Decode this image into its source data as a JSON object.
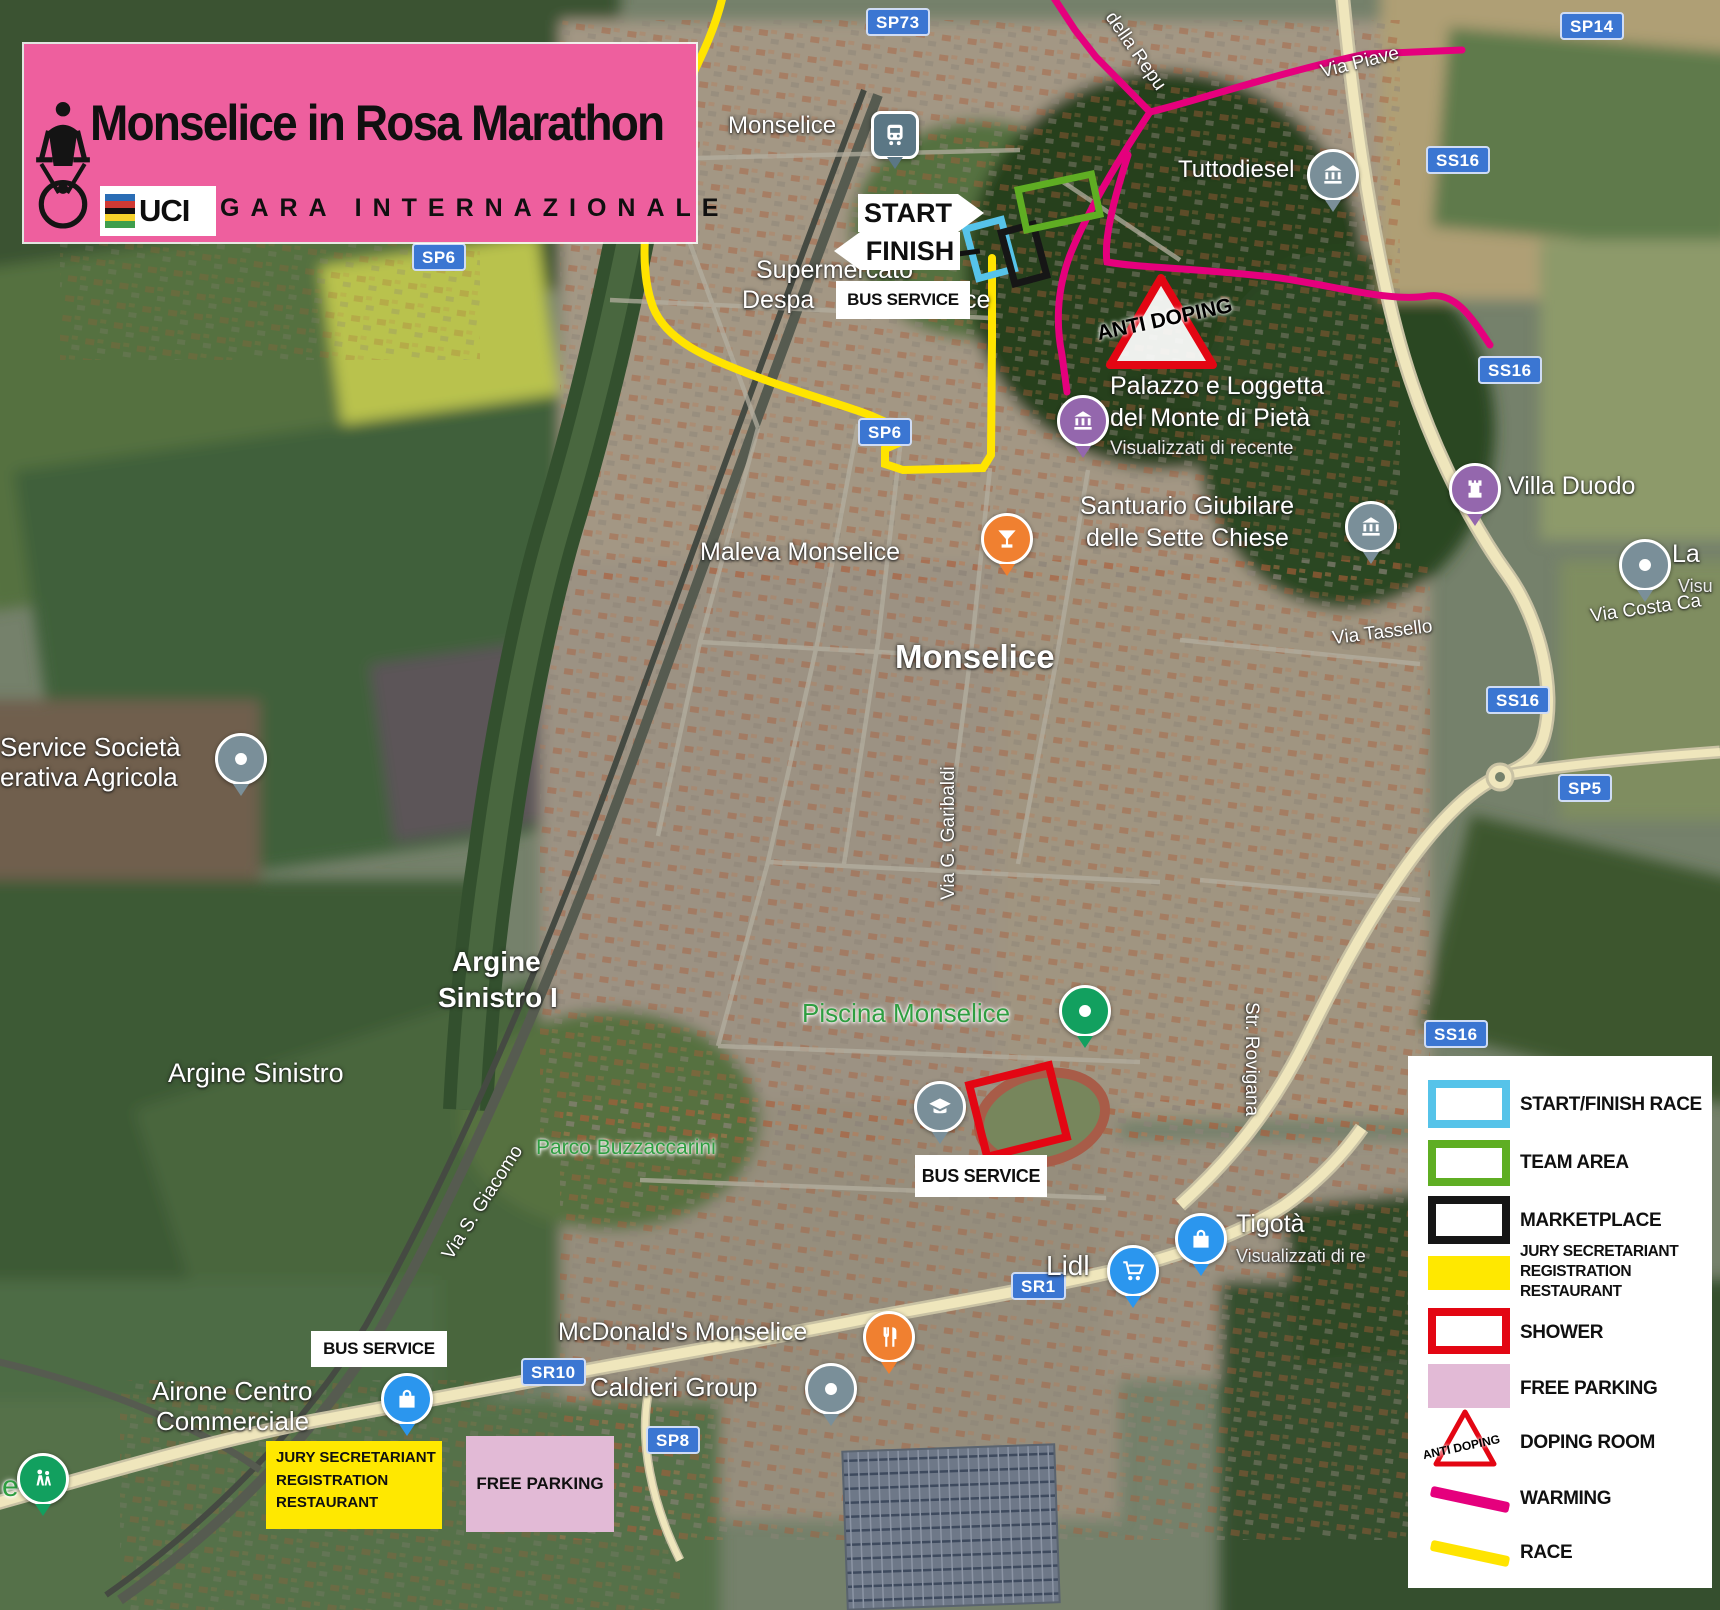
{
  "colors": {
    "banner_pink": "#ee5f9e",
    "race_yellow": "#ffe400",
    "warming_magenta": "#e5007d",
    "start_cyan": "#56c3e9",
    "team_green": "#5fae23",
    "marketplace_black": "#161616",
    "shower_red": "#e30613",
    "parking_pink": "#e2bad6",
    "jury_yellow": "#ffe800",
    "badge_blue": "#3b76d2",
    "map_label_green": "#2f9e41"
  },
  "banner": {
    "title": "Monselice in Rosa Marathon",
    "subtitle": "GARA INTERNAZIONALE",
    "uci": "UCI"
  },
  "badges": {
    "sp73": "SP73",
    "sp14": "SP14",
    "ss16": "SS16",
    "sp6": "SP6",
    "sp5": "SP5",
    "sr10": "SR10",
    "sr1": "SR1",
    "sp8": "SP8"
  },
  "streets": {
    "via_piave": "Via Piave",
    "repubblica": "della Repu",
    "tassello": "Via Tassello",
    "costa": "Via Costa Ca",
    "rovigana": "Str. Rovigana",
    "garibaldi": "Via G. Garibaldi",
    "giacomo": "Via S. Giacomo"
  },
  "places": {
    "station": "Monselice",
    "tuttodiesel": "Tuttodiesel",
    "palazzo1": "Palazzo e Loggetta",
    "palazzo2": "del Monte di Pietà",
    "palazzo3": "Visualizzati di recente",
    "santuario1": "Santuario Giubilare",
    "santuario2": "delle Sette Chiese",
    "villa": "Villa Duodo",
    "la": "La",
    "la_sub": "Visu",
    "maleva": "Maleva Monselice",
    "city": "Monselice",
    "piscina": "Piscina Monselice",
    "parco": "Parco Buzzaccarini",
    "mcdonalds": "McDonald's Monselice",
    "caldieri": "Caldieri Group",
    "airone1": "Airone Centro",
    "airone2": "Commerciale",
    "lidl": "Lidl",
    "tigota": "Tigotà",
    "tigota_sub": "Visualizzati di re",
    "service1": "Service Società",
    "service2": "erativa Agricola",
    "argine_a": "Argine Sinistro",
    "argine_b1": "Argine",
    "argine_b2": "Sinistro I",
    "supermercato1": "Supermercato",
    "supermercato2": "Despa",
    "supermercato3": "ce",
    "green_fragment": "e"
  },
  "overlays": {
    "start": "START",
    "finish": "FINISH",
    "bus_service": "BUS SERVICE",
    "anti_doping": "ANTI DOPING",
    "jury1": "JURY SECRETARIANT",
    "jury2": "REGISTRATION",
    "jury3": "RESTAURANT",
    "free_parking": "FREE PARKING"
  },
  "legend": {
    "items": [
      {
        "label": "START/FINISH RACE"
      },
      {
        "label": "TEAM AREA"
      },
      {
        "label": "MARKETPLACE"
      },
      {
        "label_lines": [
          "JURY SECRETARIANT",
          "REGISTRATION",
          "RESTAURANT"
        ]
      },
      {
        "label": "SHOWER"
      },
      {
        "label": "FREE PARKING"
      },
      {
        "label": "DOPING ROOM",
        "icon_text": "ANTI DOPING"
      },
      {
        "label": "WARMING"
      },
      {
        "label": "RACE"
      }
    ]
  }
}
